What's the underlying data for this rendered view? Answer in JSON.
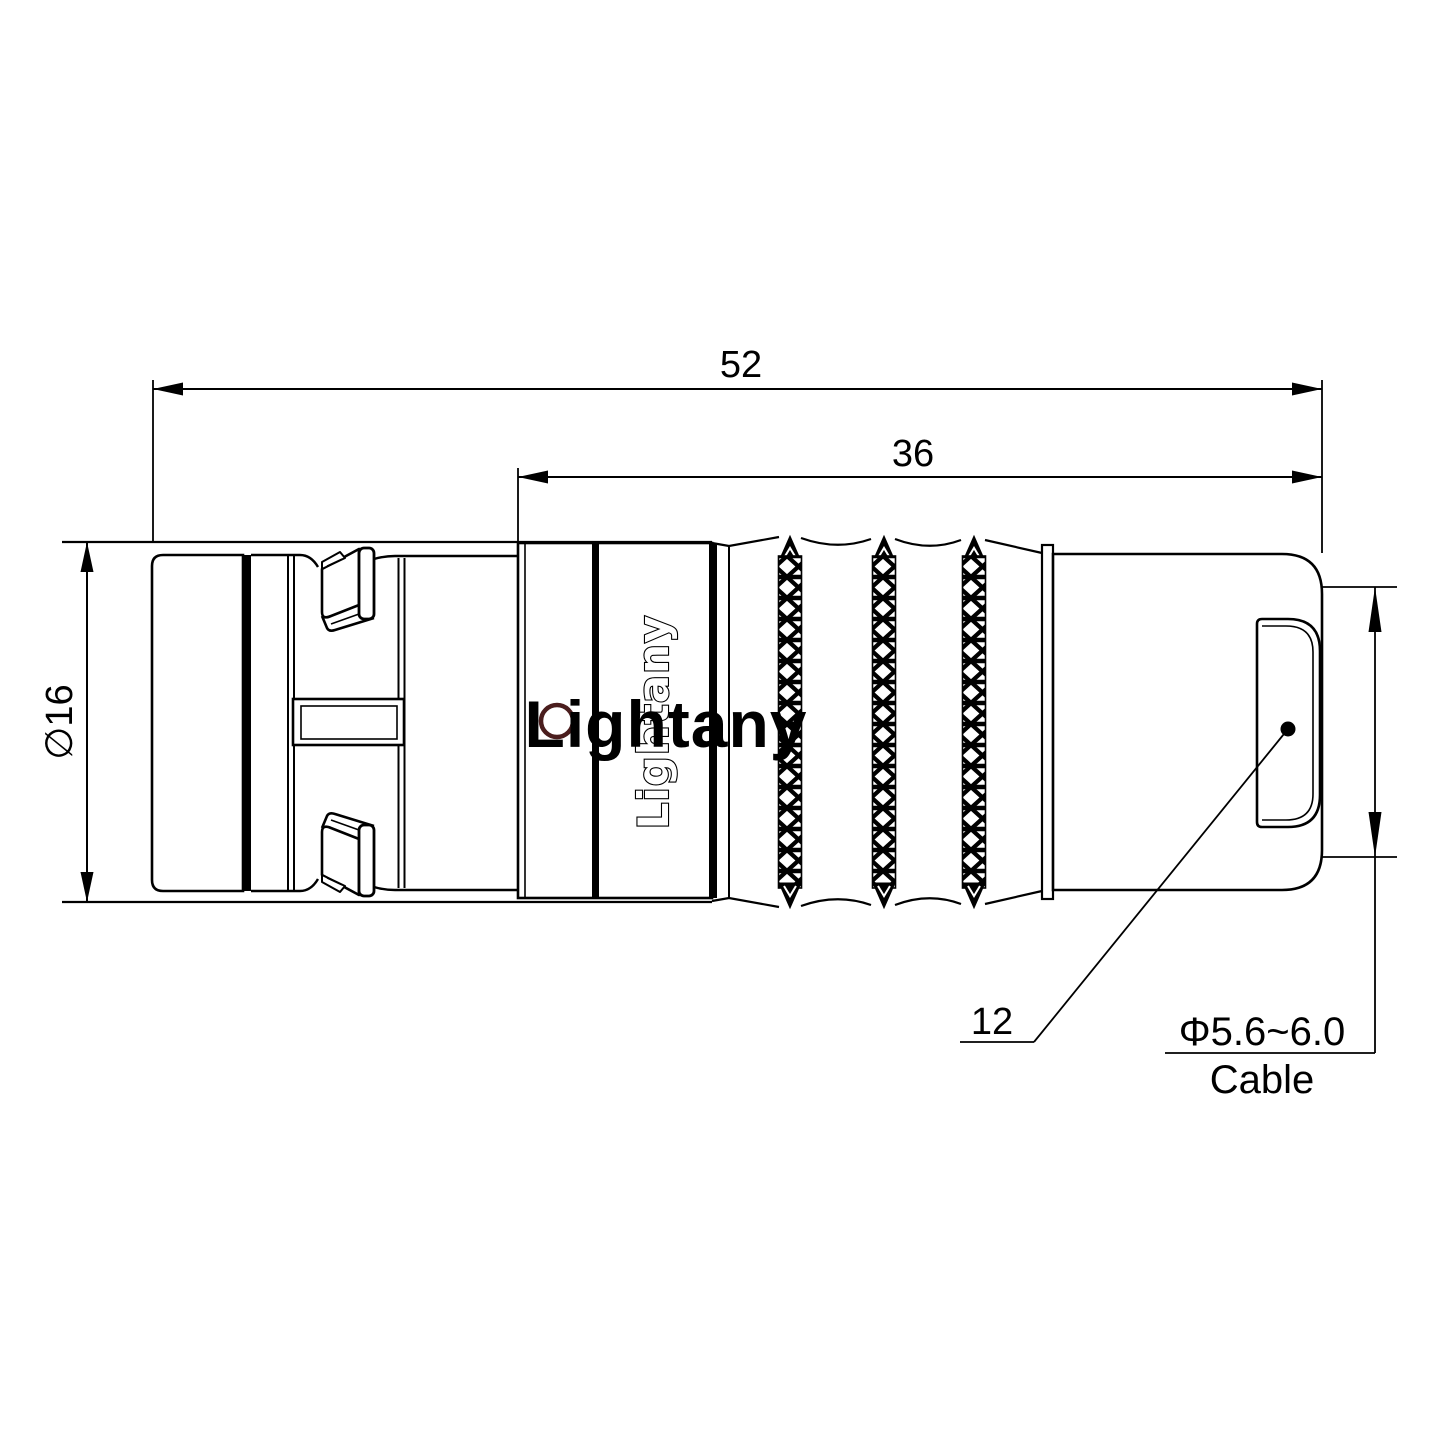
{
  "drawing": {
    "kind": "connector technical drawing, side view with dimensions",
    "background": "#ffffff",
    "line_color": "#000000",
    "hole_ring_color": "#4a1d1d"
  },
  "watermark": {
    "text": "Lightany",
    "color": "rgba(204,72,72,0.28)"
  },
  "engraving": {
    "text": "Lightany"
  },
  "dimensions": {
    "overall_length": "52",
    "rear_length": "36",
    "diameter": "∅16",
    "boot_height": "12",
    "cable_spec": "Φ5.6~6.0",
    "cable_label": "Cable"
  }
}
